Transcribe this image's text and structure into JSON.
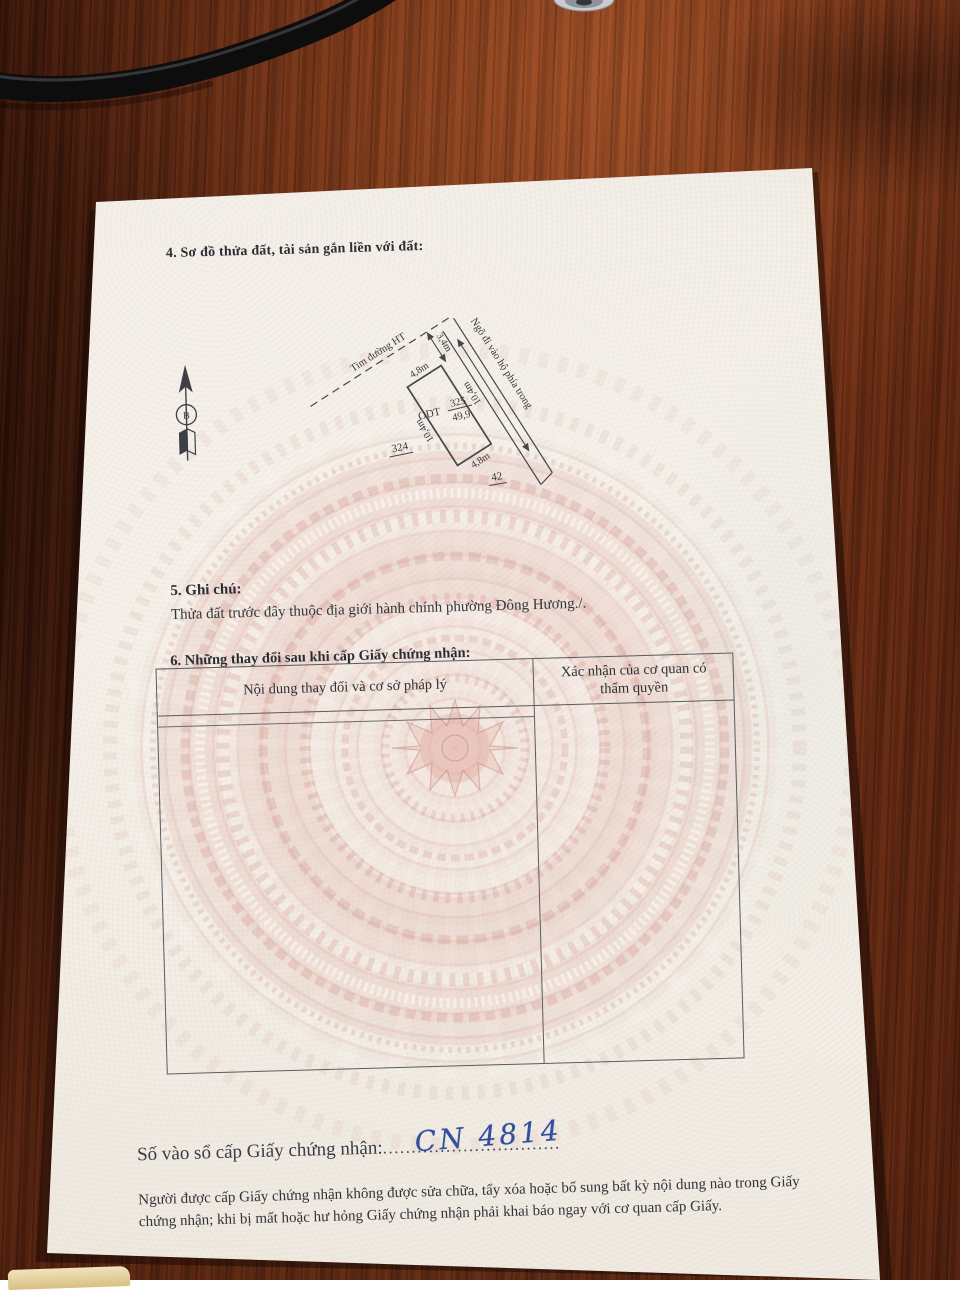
{
  "page": {
    "section4_title": "4. Sơ đồ thửa đất, tài sản gắn liền với đất:",
    "section5_title": "5. Ghi chú:",
    "section5_note": "Thửa đất trước đây thuộc địa giới hành chính phường Đông Hương./.",
    "section6_title": "6. Những thay đổi sau khi cấp Giấy chứng nhận:",
    "table": {
      "col1_header": "Nội dung thay đổi và cơ sở pháp lý",
      "col2_header": "Xác nhận của cơ quan có thẩm quyền"
    },
    "registry": {
      "label": "Số vào sổ cấp Giấy chứng nhận:",
      "dots_left": "................",
      "entry_number": "CN 4814",
      "dots_right": "..............."
    },
    "footer_note": "Người được cấp Giấy chứng nhận không được sửa chữa, tẩy xóa hoặc bổ sung bất kỳ nội dung nào trong Giấy chứng nhận; khi bị mất hoặc hư hỏng Giấy chứng nhận phải khai báo ngay với cơ quan cấp Giấy."
  },
  "diagram": {
    "north_label": "B",
    "road_centerline_label": "Tim đường HT",
    "alley_label": "Ngõ đi vào hộ phía trong",
    "distance_to_road": "3,4m",
    "edge_top": "4,8m",
    "edge_bottom": "4,8m",
    "edge_left": "10,4m",
    "edge_right": "10,4m",
    "land_use_code": "ODT",
    "parcel_number": "325",
    "parcel_area": "49,9",
    "adjacent_parcel_left": "324",
    "adjacent_parcel_bottom": "42"
  },
  "colors": {
    "handwriting_ink": "#33509f",
    "drum_pattern_pink": "#cf8276",
    "paper": "#f4efe8",
    "desk_wood": "#6b2f18",
    "cable": "#0e0d0e"
  }
}
